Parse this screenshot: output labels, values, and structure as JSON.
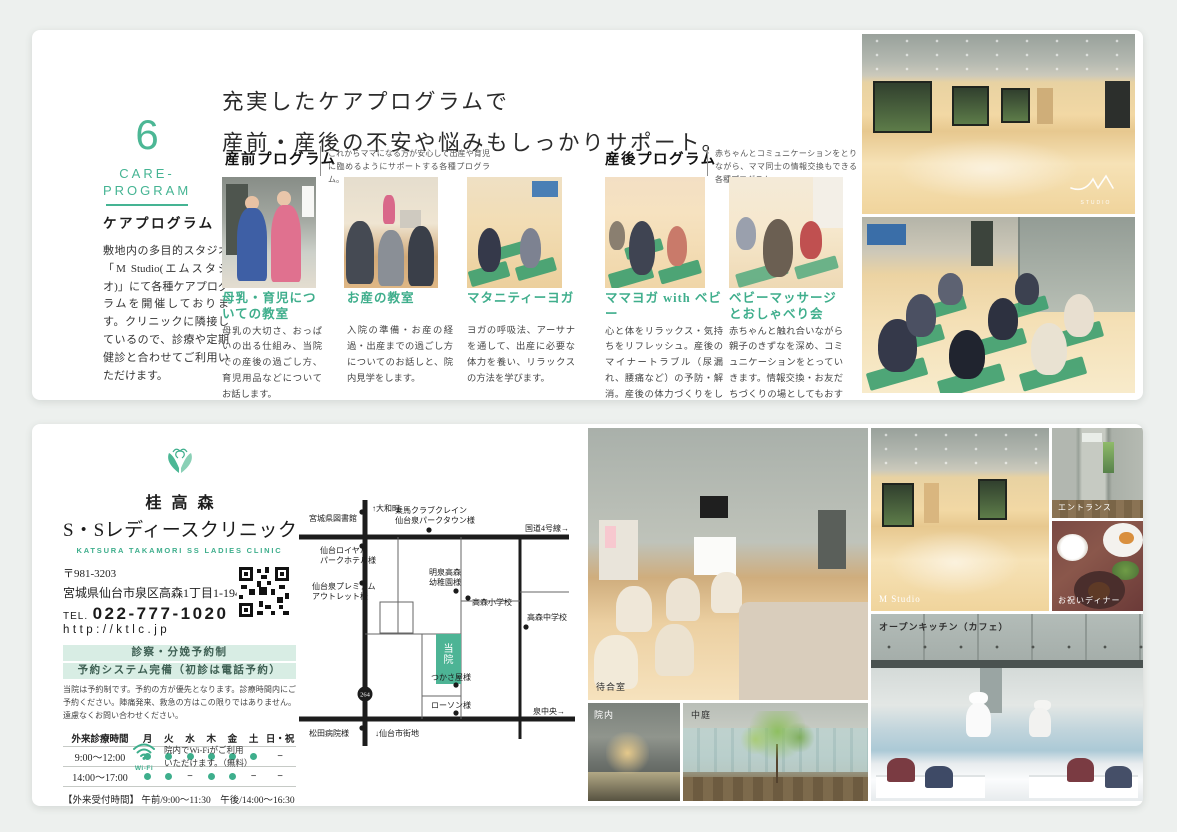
{
  "colors": {
    "accent_green": "#3EAE8C",
    "accent_green_light": "#D8EDE4",
    "page_background": "#EDF0EE",
    "clinic_box_green": "#4DB495"
  },
  "top_panel": {
    "number": "6",
    "section_en_line1": "CARE-",
    "section_en_line2": "PROGRAM",
    "section_ja": "ケアプログラム",
    "description": "敷地内の多目的スタジオ「M Studio(エムスタジオ)」にて各種ケアプログラムを開催しております。クリニックに隣接しているので、診療や定期健診と合わせてご利用いただけます。",
    "heading_line1": "充実したケアプログラムで",
    "heading_line2": "産前・産後の不安や悩みもしっかりサポート。",
    "prenatal": {
      "label": "産前プログラム",
      "note": "これからママになる方が安心して出産や育児に臨めるようにサポートする各種プログラム。",
      "programs": [
        {
          "title": "母乳・育児についての教室",
          "body": "母乳の大切さ、おっぱいの出る仕組み、当院での産後の過ごし方、育児用品などについてお話します。"
        },
        {
          "title": "お産の教室",
          "body": "入院の準備・お産の経過・出産までの過ごし方についてのお話しと、院内見学をします。"
        },
        {
          "title": "マタニティーヨガ",
          "body": "ヨガの呼吸法、アーサナを通して、出産に必要な体力を養い、リラックスの方法を学びます。"
        }
      ]
    },
    "postnatal": {
      "label": "産後プログラム",
      "note": "赤ちゃんとコミュニケーションをとりながら、ママ同士の情報交換もできる各種プログラム。",
      "programs": [
        {
          "title": "ママヨガ with ベビー",
          "body": "心と体をリラックス・気持ちをリフレッシュ。産後のマイナートラブル（尿漏れ、腰痛など）の予防・解消。産後の体力づくりをしていきます。"
        },
        {
          "title": "ベビーマッサージとおしゃべり会",
          "body": "赤ちゃんと触れ合いながら親子のきずなを深め、コミュニケーションをとっていきます。情報交換・お友だちづくりの場としてもおすすめです。"
        }
      ]
    },
    "studio_watermark": "STUDIO"
  },
  "bottom_panel": {
    "clinic": {
      "name_small": "桂高森",
      "name_large": "S・Sレディースクリニック",
      "name_en": "KATSURA TAKAMORI SS LADIES CLINIC",
      "postal": "〒981-3203",
      "address": "宮城県仙台市泉区高森1丁目1-194",
      "tel_label": "TEL.",
      "tel": "022-777-1020",
      "url": "http://ktlc.jp",
      "badge1": "診察・分娩予約制",
      "badge2": "予約システム完備（初診は電話予約）",
      "note": "当院は予約制です。予約の方が優先となります。診療時間内にご予約ください。陣痛発来、救急の方はこの限りではありません。遠慮なくお問い合わせください。",
      "hours": {
        "header": [
          "外来診療時間",
          "月",
          "火",
          "水",
          "木",
          "金",
          "土",
          "日・祝"
        ],
        "rows": [
          {
            "time": "9:00～12:00",
            "marks": [
              "dot",
              "dot",
              "dot",
              "dot",
              "dot",
              "dot",
              "dash"
            ]
          },
          {
            "time": "14:00～17:00",
            "marks": [
              "dot",
              "dot",
              "dash",
              "dot",
              "dot",
              "dash",
              "dash"
            ]
          }
        ]
      },
      "reception": "【外来受付時間】 午前/9:00～11:30　午後/14:00～16:30",
      "wifi_label": "Wi-Fi",
      "wifi_note_line1": "院内でWi-Fiがご利用",
      "wifi_note_line2": "いただけます。（無料）"
    },
    "map": {
      "clinic_label": "当院",
      "route_badge": "264",
      "labels": [
        {
          "t": "宮城県図書館",
          "x": 64,
          "y": 37,
          "a": "end"
        },
        {
          "t": "↑大和町",
          "x": 79,
          "y": 27,
          "a": "start"
        },
        {
          "t": "乗馬クラブクレイン",
          "x": 138,
          "y": 29,
          "a": "middle"
        },
        {
          "t": "仙台泉パークタウン様",
          "x": 142,
          "y": 39,
          "a": "middle"
        },
        {
          "t": "国道4号線→",
          "x": 276,
          "y": 47,
          "a": "end"
        },
        {
          "t": "仙台ロイヤル",
          "x": 27,
          "y": 69,
          "a": "start"
        },
        {
          "t": "パークホテル様",
          "x": 27,
          "y": 79,
          "a": "start"
        },
        {
          "t": "仙台泉プレミアム",
          "x": 19,
          "y": 105,
          "a": "start"
        },
        {
          "t": "アウトレット様",
          "x": 19,
          "y": 115,
          "a": "start"
        },
        {
          "t": "明泉高森",
          "x": 152,
          "y": 91,
          "a": "middle"
        },
        {
          "t": "幼稚園様",
          "x": 152,
          "y": 101,
          "a": "middle"
        },
        {
          "t": "高森小学校",
          "x": 179,
          "y": 121,
          "a": "start"
        },
        {
          "t": "高森中学校",
          "x": 234,
          "y": 136,
          "a": "start"
        },
        {
          "t": "つかさ屋様",
          "x": 138,
          "y": 196,
          "a": "start"
        },
        {
          "t": "ローソン様",
          "x": 138,
          "y": 224,
          "a": "start"
        },
        {
          "t": "泉中央→",
          "x": 272,
          "y": 230,
          "a": "end"
        },
        {
          "t": "松田病院様",
          "x": 16,
          "y": 252,
          "a": "start"
        },
        {
          "t": "↓仙台市街地",
          "x": 82,
          "y": 252,
          "a": "start"
        }
      ],
      "dots": [
        [
          69,
          28
        ],
        [
          136,
          46
        ],
        [
          69,
          62
        ],
        [
          69,
          99
        ],
        [
          163,
          107
        ],
        [
          175,
          114
        ],
        [
          233,
          143
        ],
        [
          163,
          201
        ],
        [
          163,
          229
        ],
        [
          69,
          244
        ]
      ]
    },
    "photo_labels": {
      "m_studio": "M Studio",
      "entrance": "エントランス",
      "dinner": "お祝いディナー",
      "kitchen": "オープンキッチン（カフェ）",
      "waiting": "待合室",
      "inside": "院内",
      "courtyard": "中庭"
    }
  }
}
